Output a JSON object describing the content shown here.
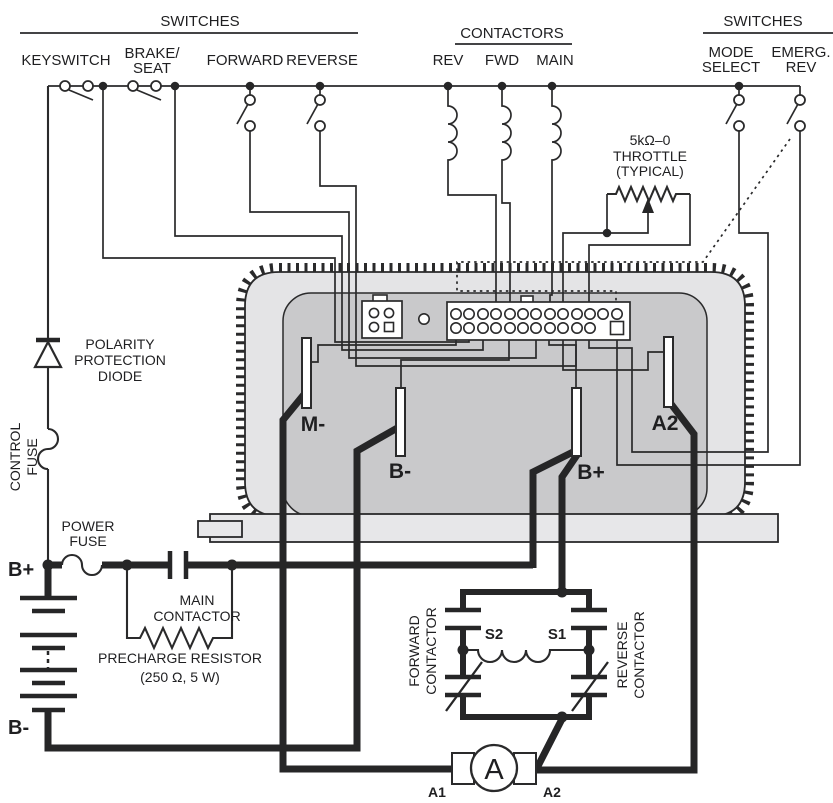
{
  "headers": {
    "switches_left": {
      "title": "SWITCHES",
      "keyswitch": "KEYSWITCH",
      "brake_line1": "BRAKE/",
      "brake_line2": "SEAT",
      "forward": "FORWARD",
      "reverse": "REVERSE"
    },
    "contactors": {
      "title": "CONTACTORS",
      "rev": "REV",
      "fwd": "FWD",
      "main": "MAIN"
    },
    "switches_right": {
      "title": "SWITCHES",
      "mode_line1": "MODE",
      "mode_line2": "SELECT",
      "emerg_line1": "EMERG.",
      "emerg_line2": "REV"
    }
  },
  "throttle": {
    "line1": "5kΩ–0",
    "line2": "THROTTLE",
    "line3": "(TYPICAL)"
  },
  "left_rail": {
    "diode_line1": "POLARITY",
    "diode_line2": "PROTECTION",
    "diode_line3": "DIODE",
    "control_fuse_line1": "CONTROL",
    "control_fuse_line2": "FUSE",
    "power_fuse_line1": "POWER",
    "power_fuse_line2": "FUSE",
    "battery_positive": "B+",
    "battery_negative": "B-"
  },
  "main_contactor": {
    "line1": "MAIN",
    "line2": "CONTACTOR",
    "precharge_line1": "PRECHARGE RESISTOR",
    "precharge_line2": "(250 Ω, 5 W)"
  },
  "controller": {
    "terminal_m_minus": "M-",
    "terminal_b_minus": "B-",
    "terminal_b_plus": "B+",
    "terminal_a2": "A2"
  },
  "bridge": {
    "forward_line1": "FORWARD",
    "forward_line2": "CONTACTOR",
    "reverse_line1": "REVERSE",
    "reverse_line2": "CONTACTOR",
    "s2": "S2",
    "s1": "S1"
  },
  "motor": {
    "symbol": "A",
    "a1": "A1",
    "a2": "A2"
  },
  "colors": {
    "line": "#2a2a2b",
    "heatsink_fill": "#e4e4e6",
    "body_fill": "#c9c9cb",
    "plate_fill": "#e7e7e9"
  }
}
